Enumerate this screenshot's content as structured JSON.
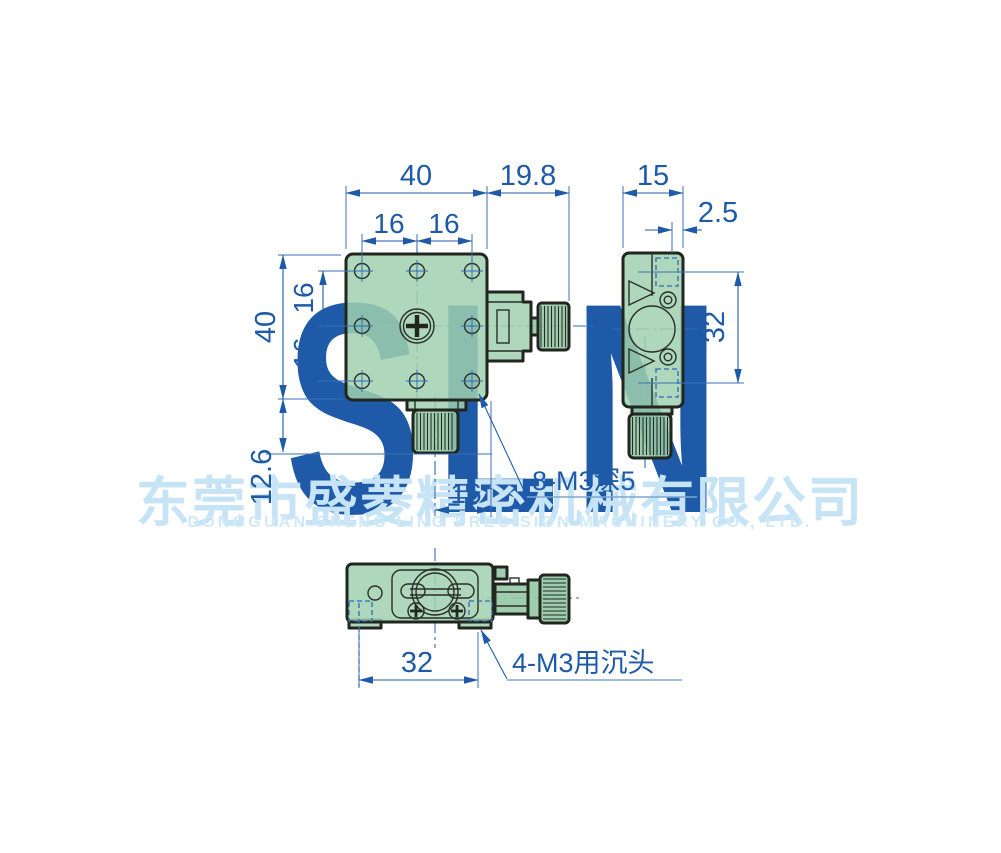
{
  "watermark": {
    "brand": "SLN",
    "company_cn": "东莞市盛菱精密机械有限公司",
    "company_en": "DONGGUAN SHENG LING PRECISION MACHINERY CO., LTD."
  },
  "colors": {
    "dimension_blue": "#1e5aa8",
    "body_green": "#a7d6b5",
    "outline_dark": "#21261f",
    "watermark_blue": "#d7edfa"
  },
  "dimensions": {
    "front_width": "40",
    "front_pitch_h1": "16",
    "front_pitch_h2": "16",
    "knob_extension": "19.8",
    "side_width": "15",
    "side_offset": "2.5",
    "side_hole_span": "32",
    "front_height": "40",
    "front_pitch_v1": "16",
    "front_pitch_v2": "16",
    "knob_drop": "12.6",
    "base_knob_offset": "16",
    "countersink_span": "32"
  },
  "callouts": {
    "tapped_holes": "8-M3深5",
    "countersunk_holes": "4-M3用沉头"
  }
}
